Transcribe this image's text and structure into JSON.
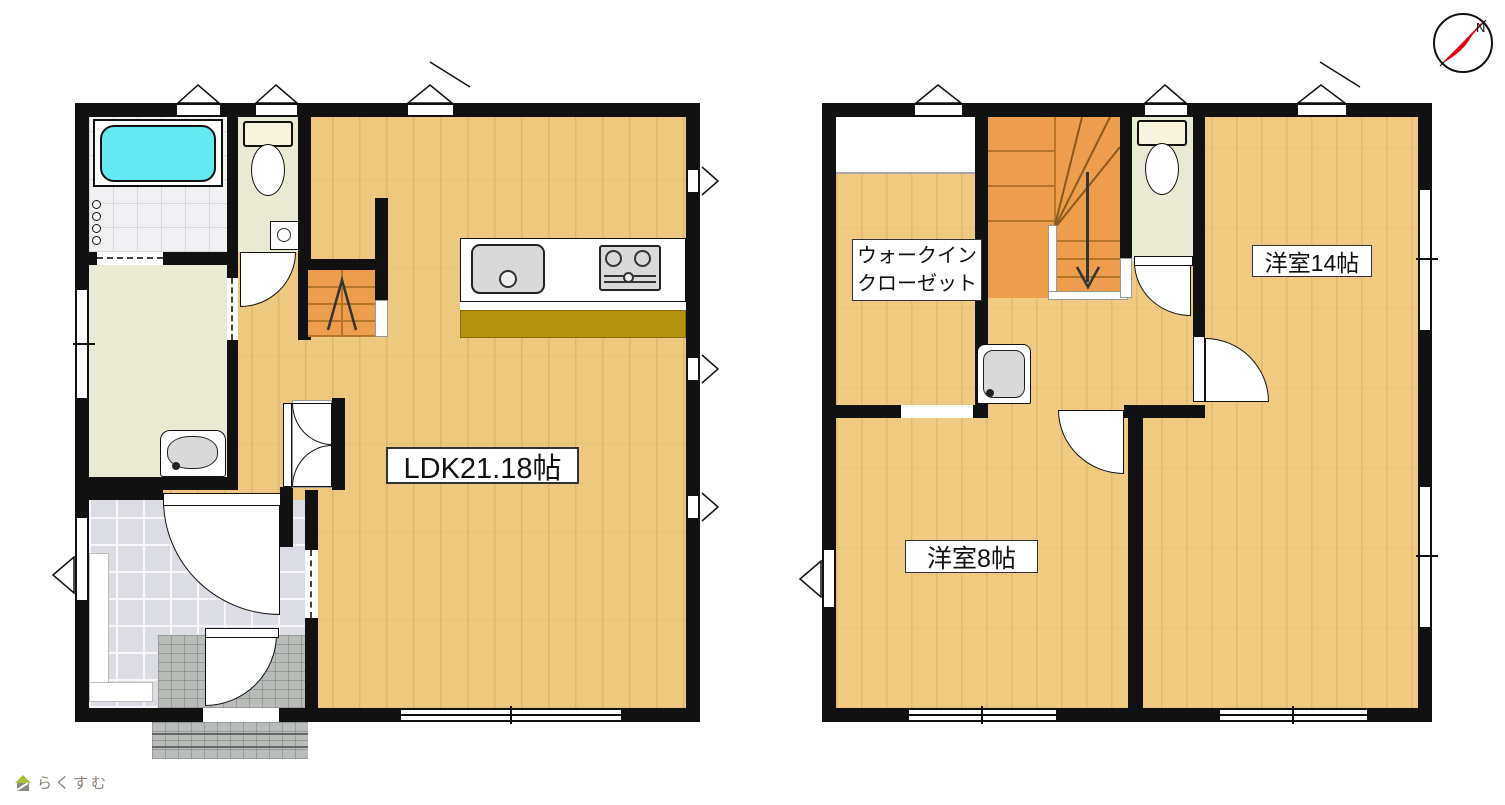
{
  "plan": {
    "floor1": {
      "ldk_label": "LDK21.18帖"
    },
    "floor2": {
      "room14_label": "洋室14帖",
      "room8_label": "洋室8帖",
      "wic_line1": "ウォークイン",
      "wic_line2": "クローゼット"
    },
    "compass": {
      "north_label": "N"
    },
    "branding": {
      "logo_text": "らくすむ"
    },
    "colors": {
      "wall": "#111111",
      "wood1": "#eec87e",
      "wood2": "#f0ca81",
      "room_beige": "#eae9d3",
      "stairs": "#ec9e4d",
      "stair_line": "#b5762a",
      "bathtub": "#63e9f2",
      "kitchen_cabinet": "#b5920e",
      "genkan_tile": "#dcdde4",
      "porch_tile": "#b9bdb9",
      "compass_red": "#e60012",
      "logo": "#8b7d6f"
    }
  }
}
